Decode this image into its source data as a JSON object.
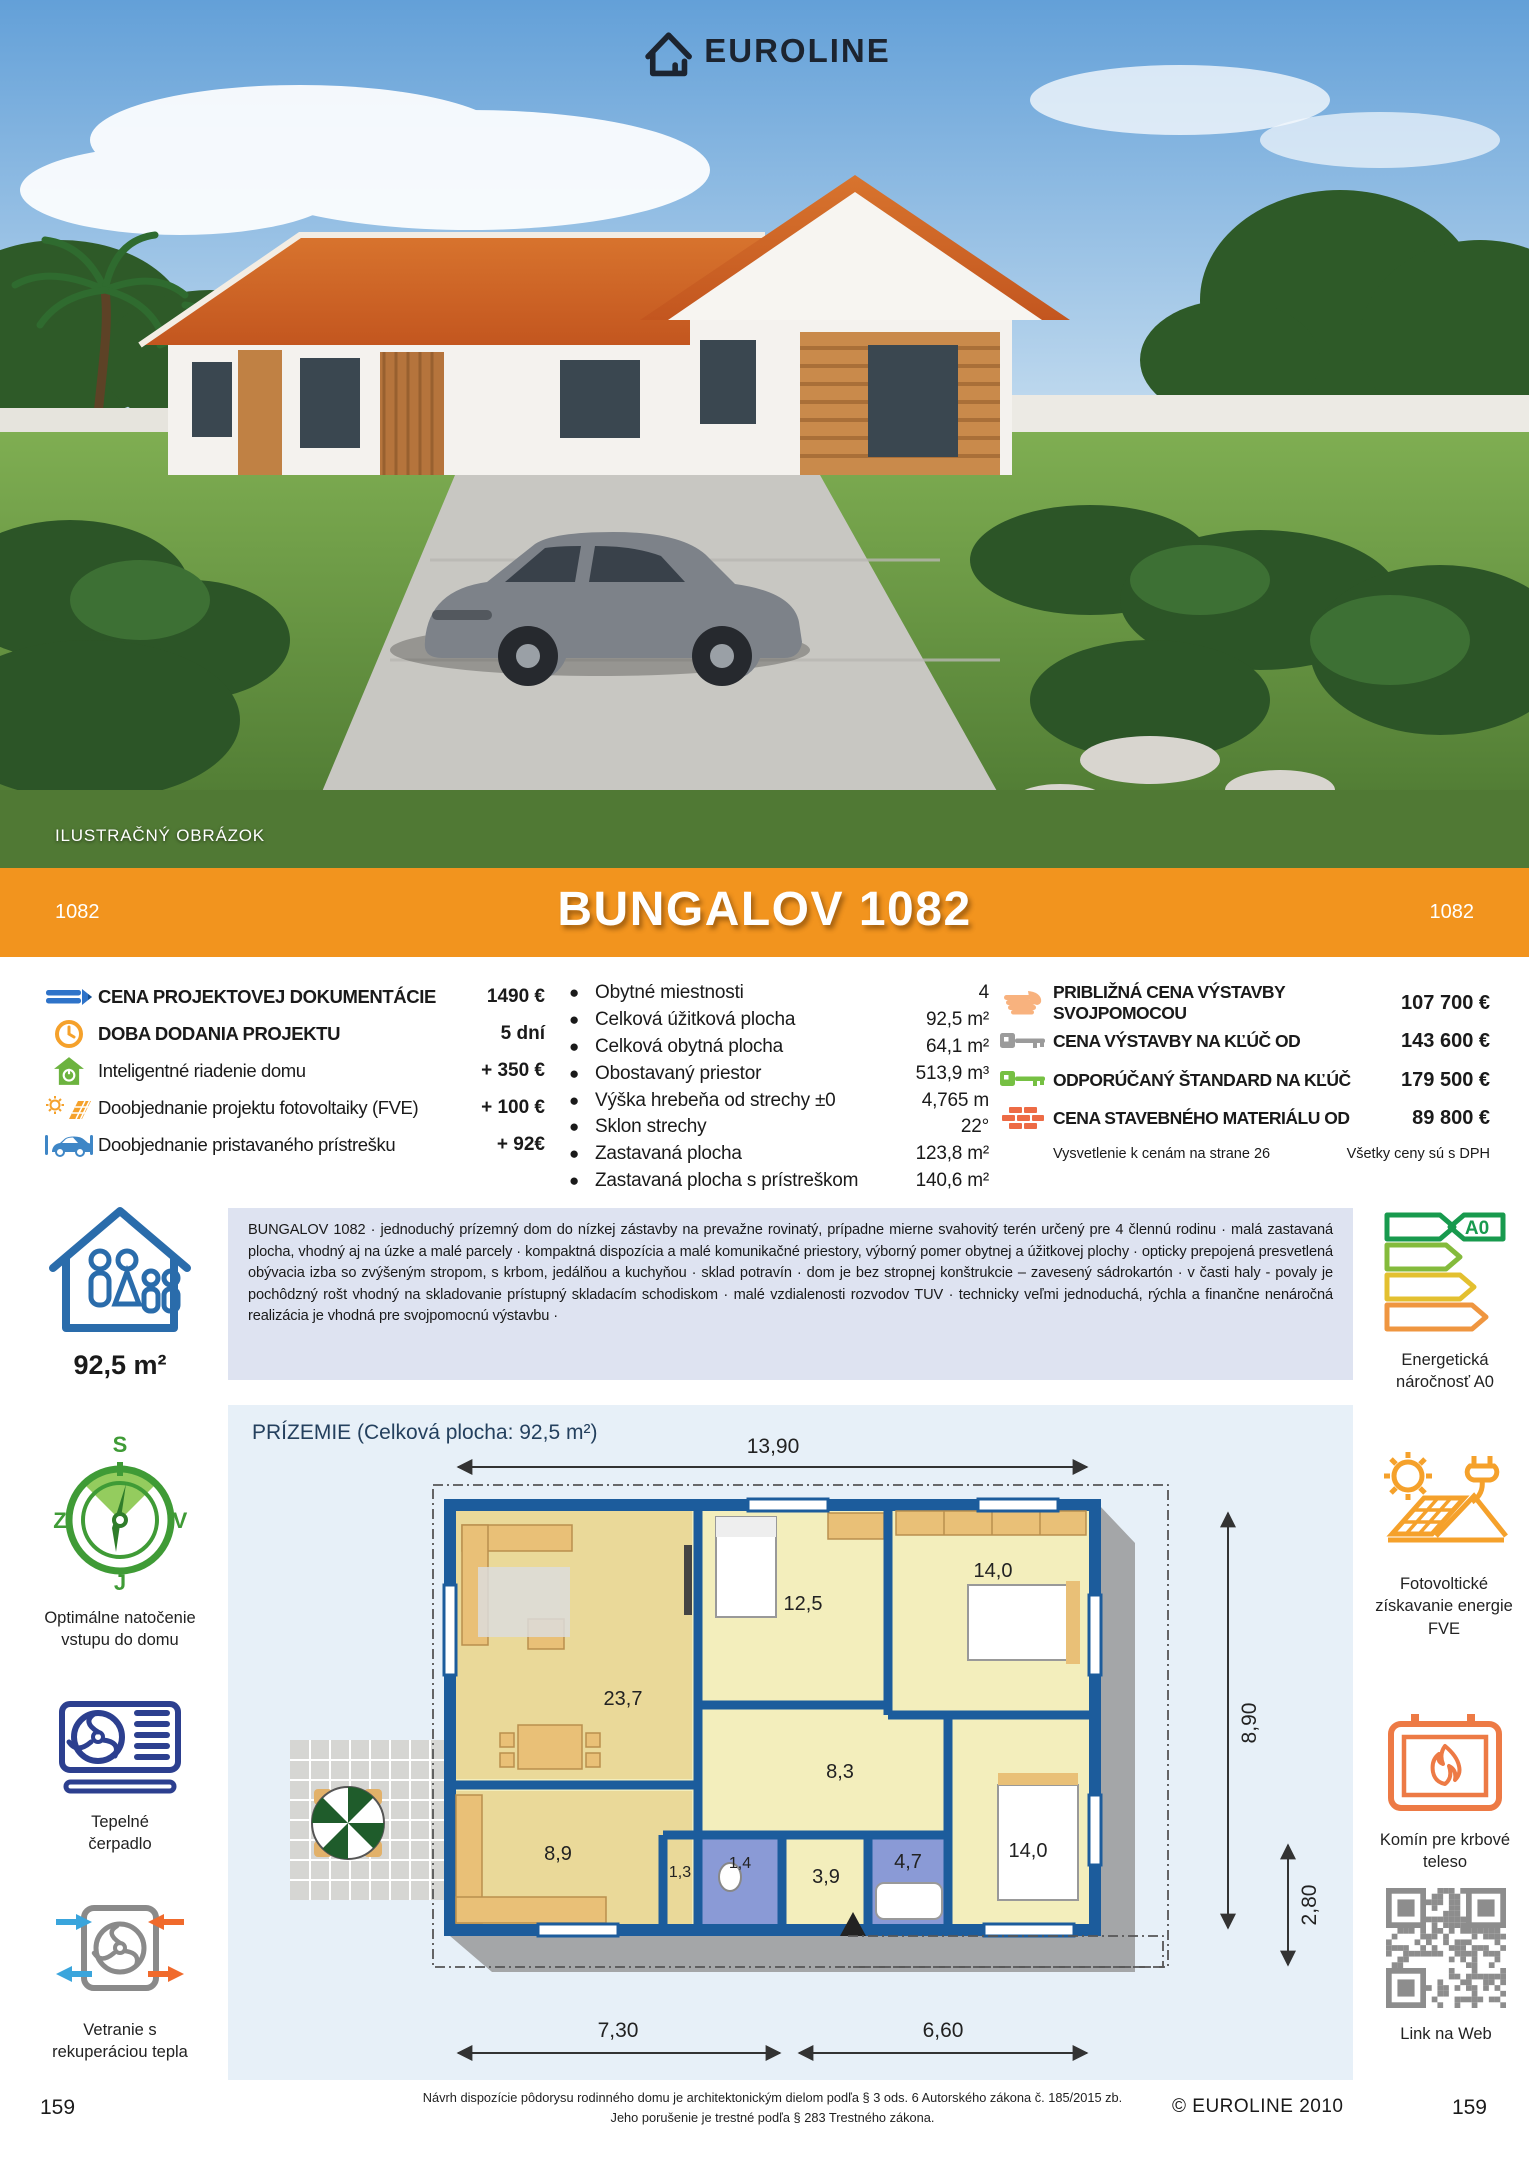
{
  "page": {
    "brand": "EUROLINE",
    "photo_caption": "ILUSTRAČNÝ OBRÁZOK",
    "code": "1082",
    "title": "BUNGALOV 1082",
    "page_number": "159",
    "copyright": "© EUROLINE 2010",
    "legal_line1": "Návrh dispozície pôdorysu rodinného domu je architektonickým dielom podľa § 3 ods. 6 Autorského zákona č. 185/2015 zb.",
    "legal_line2": "Jeho porušenie je trestné podľa § 283 Trestného zákona."
  },
  "left_specs": {
    "items": [
      {
        "icon": "pencil-icon",
        "label": "CENA PROJEKTOVEJ DOKUMENTÁCIE",
        "value": "1490 €"
      },
      {
        "icon": "clock-icon",
        "label": "DOBA DODANIA PROJEKTU",
        "value": "5 dní"
      },
      {
        "icon": "smart-home-icon",
        "label": "Inteligentné riadenie domu",
        "value": "+ 350 €"
      },
      {
        "icon": "solar-panel-icon",
        "label": "Doobjednanie projektu fotovoltaiky (FVE)",
        "value": "+ 100 €"
      },
      {
        "icon": "carport-icon",
        "label": "Doobjednanie pristavaného prístrešku",
        "value": "+ 92€"
      }
    ]
  },
  "params": {
    "items": [
      {
        "label": "Obytné miestnosti",
        "value": "4"
      },
      {
        "label": "Celková úžitková plocha",
        "value": "92,5 m²"
      },
      {
        "label": "Celková obytná plocha",
        "value": "64,1 m²"
      },
      {
        "label": "Obostavaný priestor",
        "value": "513,9 m³"
      },
      {
        "label": "Výška hrebeňa od strechy ±0",
        "value": "4,765 m"
      },
      {
        "label": "Sklon strechy",
        "value": "22°"
      },
      {
        "label": "Zastavaná plocha",
        "value": "123,8 m²"
      },
      {
        "label": "Zastavaná plocha s prístreškom",
        "value": "140,6 m²"
      }
    ]
  },
  "prices": {
    "items": [
      {
        "icon": "hand-icon",
        "label": "PRIBLIŽNÁ CENA VÝSTAVBY SVOJPOMOCOU",
        "value": "107 700 €"
      },
      {
        "icon": "key-turnkey-icon",
        "label": "CENA VÝSTAVBY NA KĽÚČ OD",
        "value": "143 600 €"
      },
      {
        "icon": "key-standard-icon",
        "label": "ODPORÚČANÝ ŠTANDARD NA KĽÚČ",
        "value": "179 500 €"
      },
      {
        "icon": "bricks-icon",
        "label": "CENA STAVEBNÉHO MATERIÁLU OD",
        "value": "89 800 €"
      }
    ],
    "note_left": "Vysvetlenie k cenám na strane 26",
    "note_right": "Všetky ceny sú s DPH"
  },
  "summary": {
    "area": "92,5 m²",
    "description": "BUNGALOV 1082 · jednoduchý prízemný dom do nízkej zástavby na prevažne rovinatý, prípadne mierne svahovitý terén určený pre 4 člennú rodinu · malá zastavaná plocha, vhodný aj na úzke a malé parcely · kompaktná dispozícia a malé komunikačné priestory, výborný pomer obytnej a úžitkovej plochy · opticky prepojená presvetlená obývacia izba so zvýšeným stropom, s krbom, jedálňou a kuchyňou · sklad potravín ·  dom je bez stropnej konštrukcie – zavesený sádrokartón · v časti haly - povaly je pochôdzný rošt vhodný na skladovanie prístupný skladacím schodiskom · malé vzdialenosti rozvodov TUV · technicky veľmi jednoduchá, rýchla a finančne nenáročná realizácia je vhodná pre svojpomocnú výstavbu ·",
    "energy_badge": "A0",
    "energy_caption": "Energetická\nnáročnosť A0"
  },
  "sidebar": {
    "compass": {
      "n": "S",
      "w": "Z",
      "e": "V",
      "s": "J",
      "caption": "Optimálne natočenie\nvstupu do domu"
    },
    "heatpump_caption": "Tepelné\nčerpadlo",
    "ventilation_caption": "Vetranie s\nrekuperáciou tepla",
    "fve_caption": "Fotovoltické\nzískavanie energie\nFVE",
    "fireplace_caption": "Komín pre krbové\nteleso",
    "qr_caption": "Link na Web"
  },
  "floorplan": {
    "heading": "PRÍZEMIE (Celková plocha: 92,5 m²)",
    "dims": {
      "width": "13,90",
      "depth": "8,90",
      "porch": "2,80",
      "bottom_left": "7,30",
      "bottom_right": "6,60"
    },
    "rooms": {
      "living": "23,7",
      "kitchen": "8,9",
      "pantry": "1,3",
      "bedroom1": "12,5",
      "hall": "8,3",
      "wc": "1,4",
      "corridor": "3,9",
      "bathroom": "4,7",
      "bedroom2": "14,0",
      "bedroom3": "14,0"
    }
  },
  "colors": {
    "banner_orange": "#f2941e",
    "desc_bg": "#dee3f1",
    "plan_bg": "#e7f0f8",
    "wall_blue": "#1c5c9c",
    "accent_green": "#6cb33f",
    "accent_orange": "#f5a12b",
    "brick_red": "#ed6b45"
  }
}
